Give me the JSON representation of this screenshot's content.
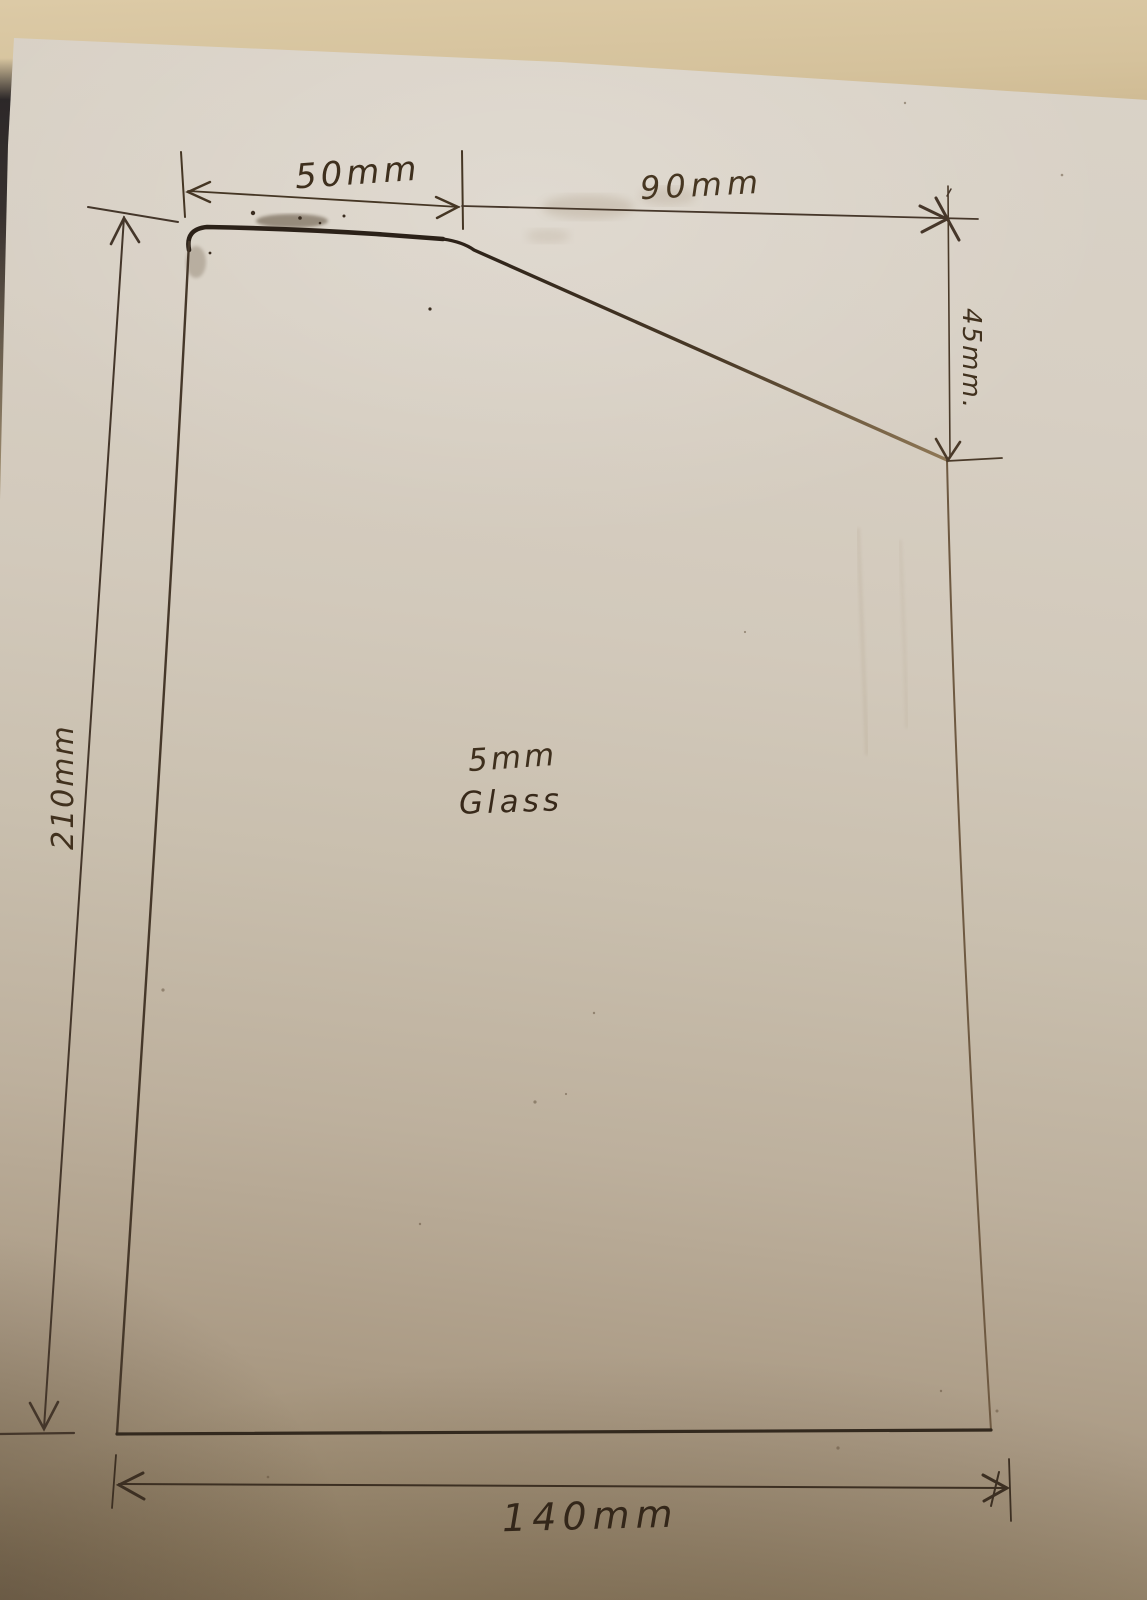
{
  "diagram": {
    "material_note": {
      "line1": "5mm",
      "line2": "Glass"
    },
    "dimensions": {
      "top_left_width": "50mm",
      "top_right_width": "90mm",
      "right_drop": "45mm.",
      "left_height": "210mm",
      "bottom_width": "140mm"
    }
  },
  "colors": {
    "ink": "#3a2d1e",
    "ink_bold": "#2b2118",
    "ink_faded": "#8f7856",
    "paper_light": "#d9d2c7",
    "paper_dark": "#8d7b5f",
    "table_surface": "#d5c29c"
  }
}
